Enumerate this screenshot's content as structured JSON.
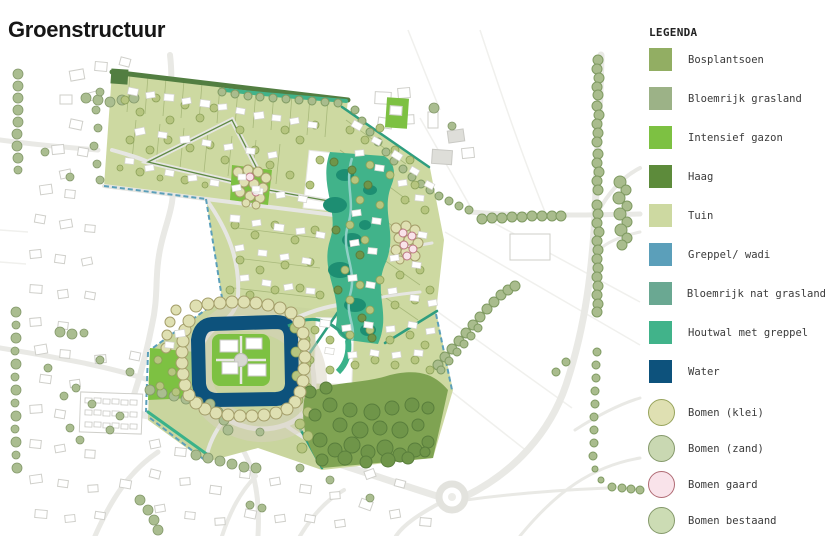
{
  "title": "Groenstructuur",
  "legend": {
    "heading": "LEGENDA",
    "items": [
      {
        "key": "bos",
        "label": "Bosplantsoen",
        "shape": "square",
        "fill": "#92ae63"
      },
      {
        "key": "grasland",
        "label": "Bloemrijk grasland",
        "shape": "square",
        "fill": "#9cb287"
      },
      {
        "key": "gazon",
        "label": "Intensief gazon",
        "shape": "square",
        "fill": "#7dc142"
      },
      {
        "key": "haag",
        "label": "Haag",
        "shape": "square",
        "fill": "#5d8b3b"
      },
      {
        "key": "tuin",
        "label": "Tuin",
        "shape": "square",
        "fill": "#cdd9a1"
      },
      {
        "key": "wadi",
        "label": "Greppel/ wadi",
        "shape": "square",
        "fill": "#5b9fba"
      },
      {
        "key": "natgras",
        "label": "Bloemrijk nat grasland",
        "shape": "square",
        "fill": "#6aa892"
      },
      {
        "key": "houtwal",
        "label": "Houtwal met greppel",
        "shape": "square",
        "fill": "#41b38a"
      },
      {
        "key": "water",
        "label": "Water",
        "shape": "square",
        "fill": "#0d527c"
      },
      {
        "key": "klei",
        "label": "Bomen (klei)",
        "shape": "circle",
        "fill": "#dfe0b2",
        "stroke": "#97a35b"
      },
      {
        "key": "zand",
        "label": "Bomen (zand)",
        "shape": "circle",
        "fill": "#c9d8b2",
        "stroke": "#85996b"
      },
      {
        "key": "gaard",
        "label": "Bomen gaard",
        "shape": "circle",
        "fill": "#f9e3ea",
        "stroke": "#b06b74"
      },
      {
        "key": "bestaand",
        "label": "Bomen bestaand",
        "shape": "circle",
        "fill": "#ccdcb4",
        "stroke": "#85996b"
      }
    ]
  }
}
